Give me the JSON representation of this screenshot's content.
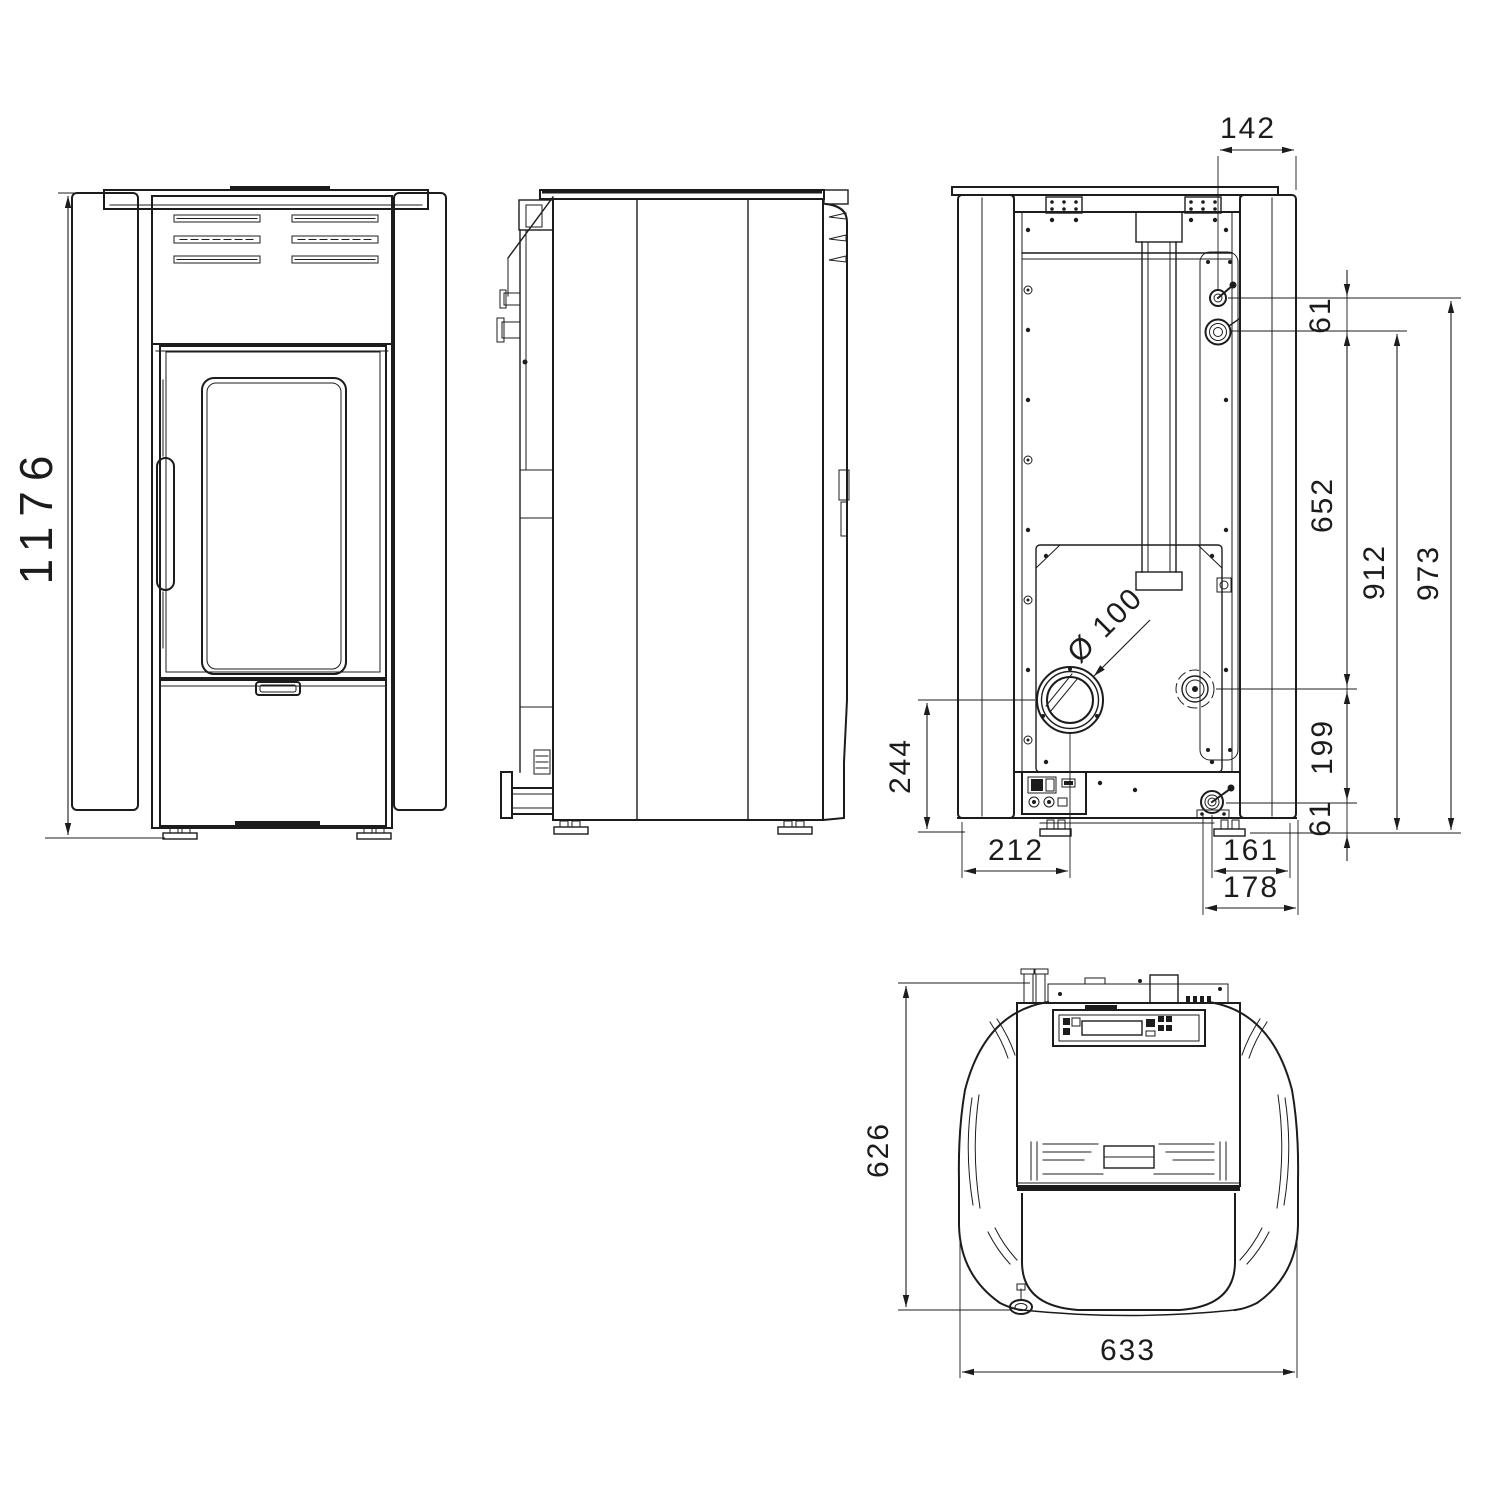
{
  "drawing": {
    "type": "technical-dimension-drawing",
    "subject": "pellet stove - four orthographic views with dimensions (mm)",
    "line_color": "#1c1c1c",
    "background": "#ffffff",
    "views": {
      "front": {
        "label": "front-view",
        "dims": {
          "height": "1176"
        }
      },
      "side": {
        "label": "side-view"
      },
      "rear": {
        "label": "rear-view",
        "dims": {
          "top_offset": "142",
          "upper_gap": "61",
          "upper_span": "652",
          "mid_span": "912",
          "total": "973",
          "lower_span": "199",
          "lower_gap": "61",
          "flue_height": "244",
          "flue_offset_left": "212",
          "outlet_offset_right": "161",
          "outlet_edge_right": "178",
          "flue_diameter": "Ø 100"
        }
      },
      "top": {
        "label": "top-view",
        "dims": {
          "depth": "626",
          "width": "633"
        }
      }
    }
  }
}
